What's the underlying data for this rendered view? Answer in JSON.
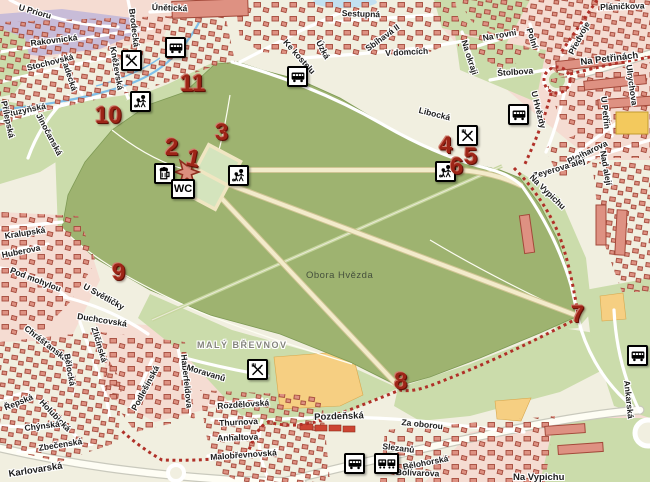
{
  "map": {
    "park_label": "Obora Hvězda",
    "district_label": "MALÝ BŘEVNOV",
    "wc_label": "WC",
    "colors": {
      "park_green": "#9EB370",
      "light_green": "#CBDCAB",
      "background_cream": "#F1EFE0",
      "residential_pink": "#F5DCD2",
      "industrial_purple": "#C8BCD8",
      "building_fill": "#DE9182",
      "building_outline": "#A3493A",
      "field_orange": "#F6CF82",
      "trail_red": "#B03028",
      "marker_red": "#9D2517",
      "water_blue": "#7FBFE8",
      "road_white": "#FFFFFF"
    }
  },
  "markers": [
    "1",
    "2",
    "3",
    "4",
    "5",
    "6",
    "7",
    "8",
    "9",
    "10",
    "11"
  ],
  "streets": [
    "U Prioru",
    "Rakovnická",
    "Únětická",
    "Brodecká",
    "Kněževská",
    "Ladecká",
    "Stochovská",
    "Ruzyňská",
    "Přílepská",
    "Jinočanská",
    "Sestupná",
    "Sbíhavá II",
    "V domcích",
    "Ke kostelu",
    "Úzká",
    "Pláničkova",
    "Na rovni",
    "Polní",
    "Předvoje",
    "Na Petřinách",
    "Na okraji",
    "Štolbova",
    "Libocká",
    "Ulrychova",
    "U Petřin",
    "U Hvězdy",
    "Plojharova",
    "Zeyerova alej",
    "Nad alejí",
    "Na Vypichu",
    "Kralupská",
    "Huberova",
    "Pod mohylou",
    "U Světličky",
    "Duchcovská",
    "Chrášťanská",
    "Řepská",
    "Bělocká",
    "Holubická",
    "Chýnská",
    "Zbečenská",
    "Karlovarská",
    "Zličínská",
    "Podlešínská",
    "Haberfeldova",
    "Moravanů",
    "Rozdělovská",
    "Thurnova",
    "Anhaltova",
    "Malobřevnovská",
    "Pozdeňská",
    "Za oborou",
    "Slezanů",
    "Bělohorská",
    "Bolívarova",
    "Ankarská",
    "Na Vypichu"
  ],
  "icons": {
    "bus": "bus-stop",
    "tram": "tram-stop",
    "restaurant": "restaurant",
    "playground": "playground",
    "pub": "pub",
    "wc": "toilets",
    "palace": "hvezda-summer-palace",
    "trail": "red-tourist-trail"
  }
}
